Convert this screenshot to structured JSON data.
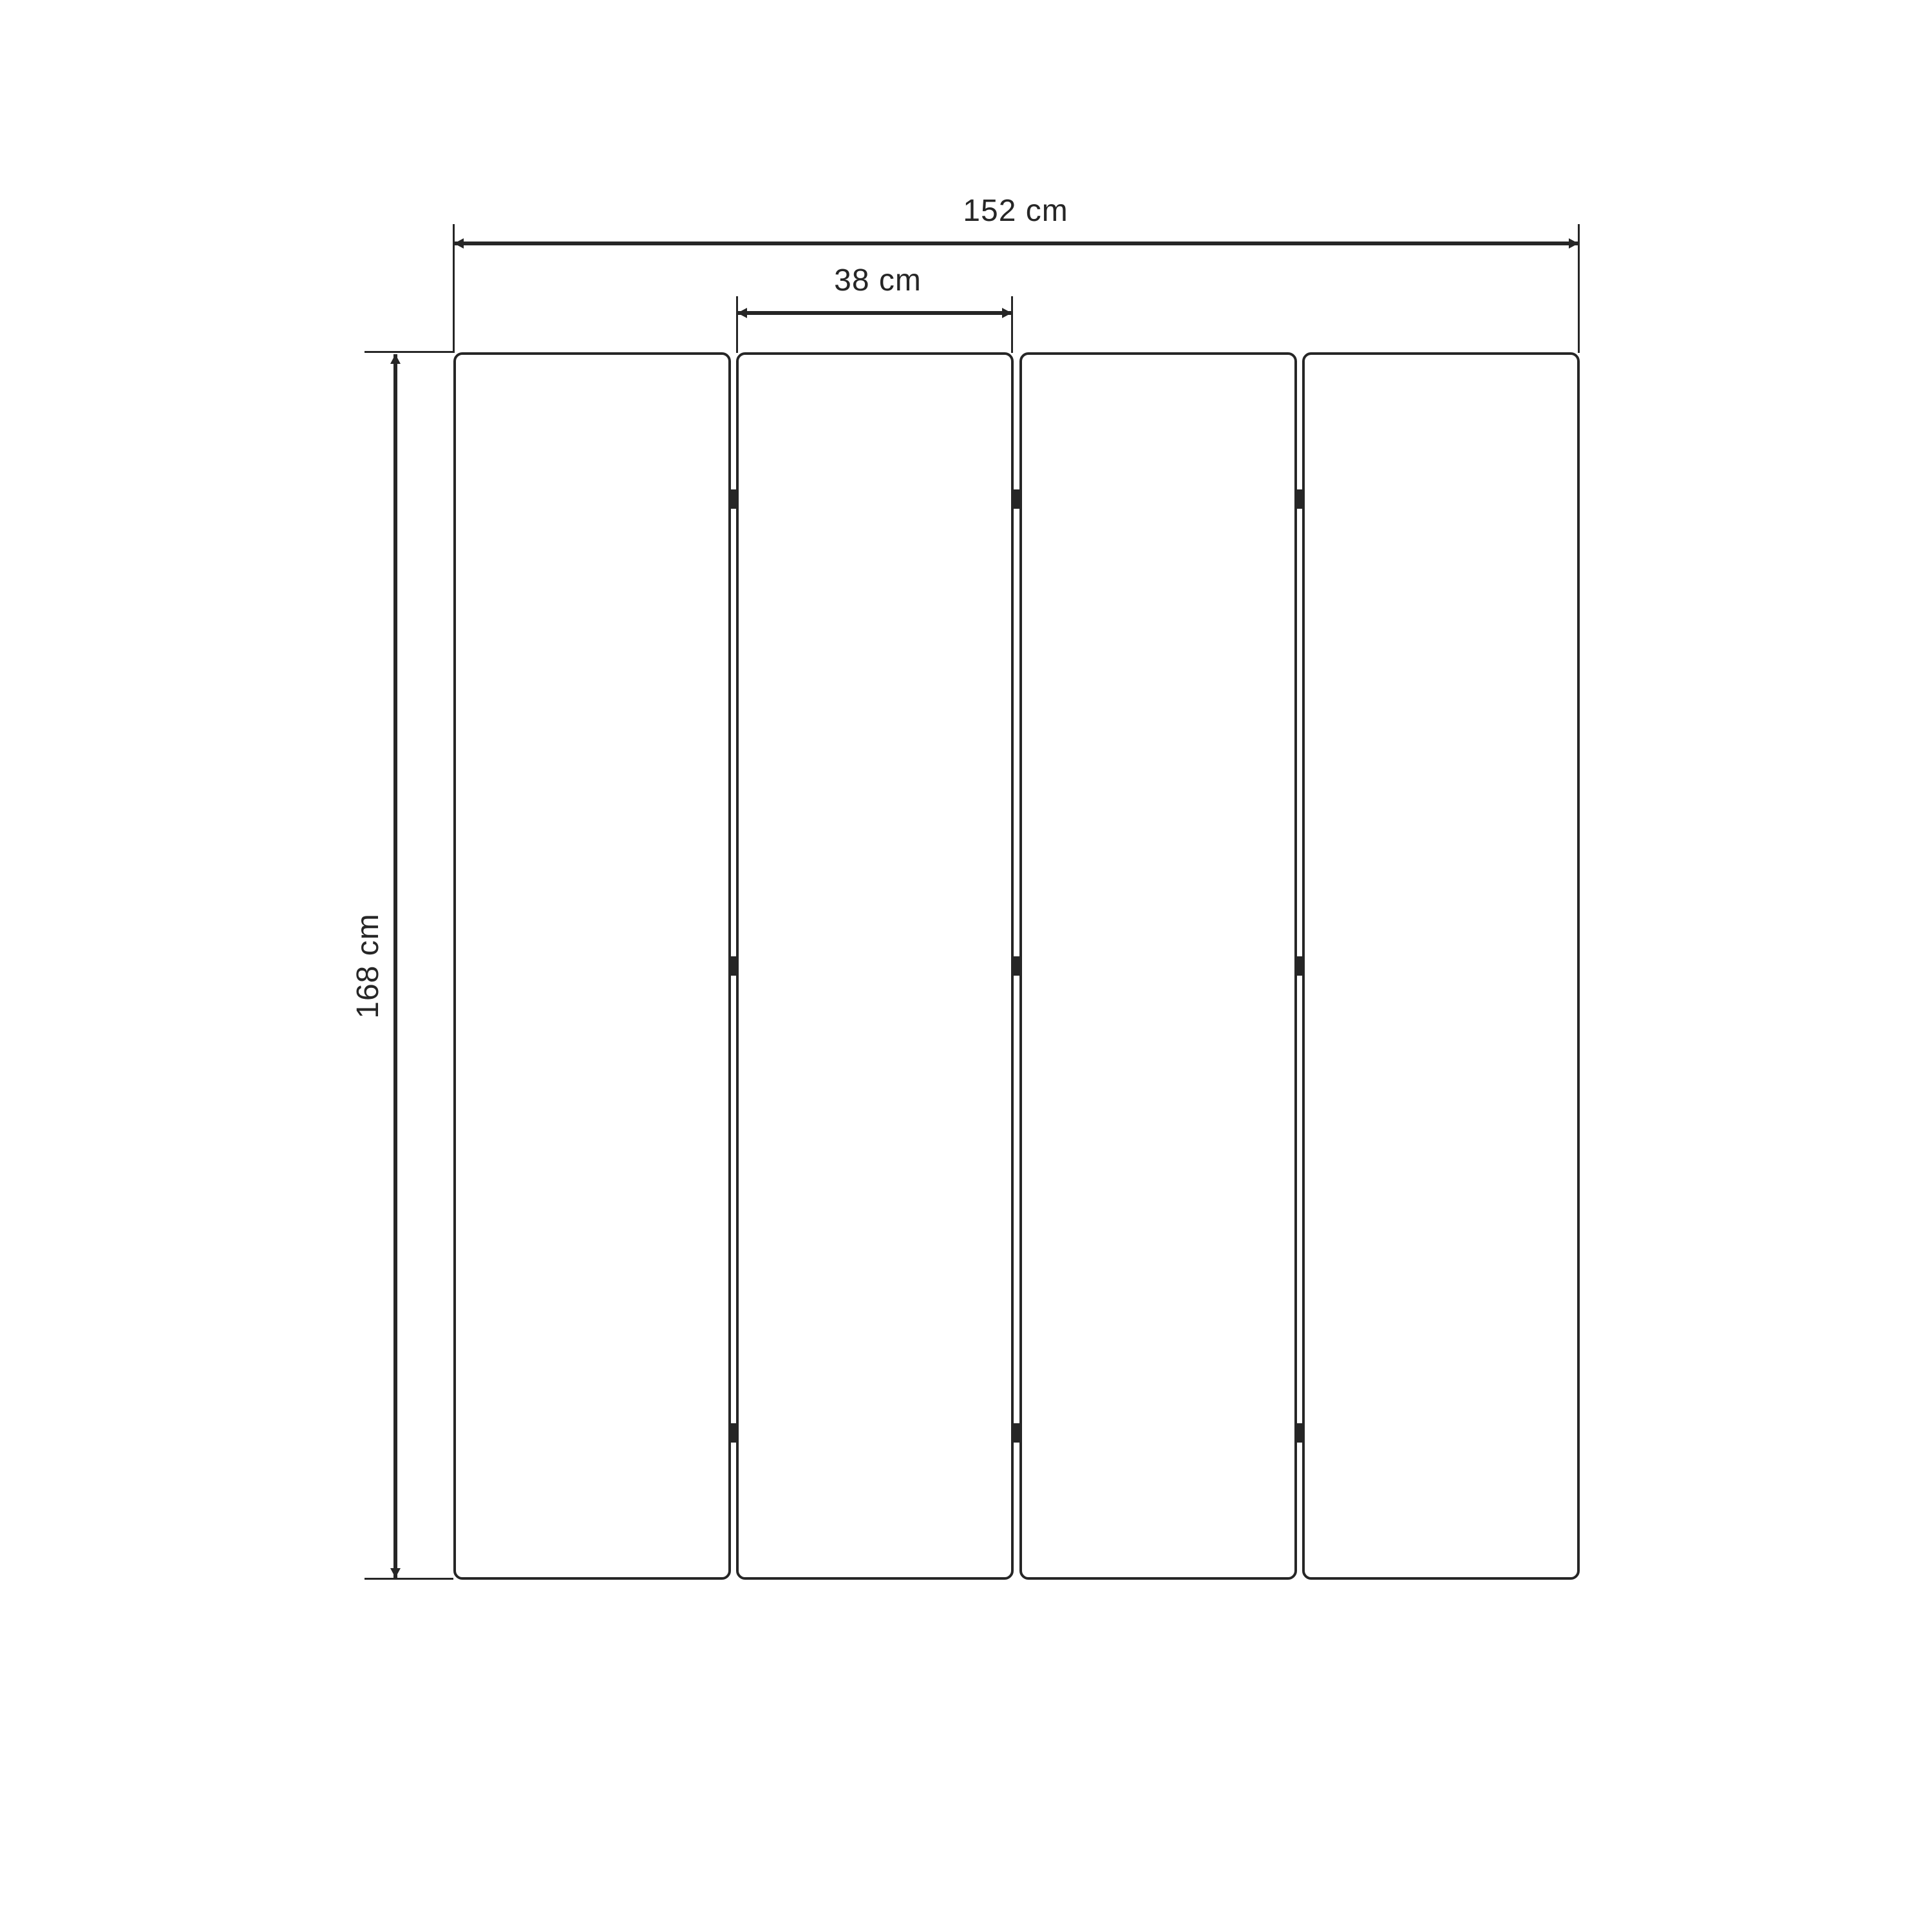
{
  "diagram": {
    "subject": "four-panel folding screen front view",
    "panel_count": 4,
    "hinge_rows": 3,
    "dimensions": {
      "total_width": {
        "label": "152 cm",
        "value": 152,
        "unit": "cm"
      },
      "panel_width": {
        "label": "38 cm",
        "value": 38,
        "unit": "cm"
      },
      "height": {
        "label": "168 cm",
        "value": 168,
        "unit": "cm"
      }
    },
    "colors": {
      "ink": "#262626",
      "background": "#ffffff"
    }
  }
}
